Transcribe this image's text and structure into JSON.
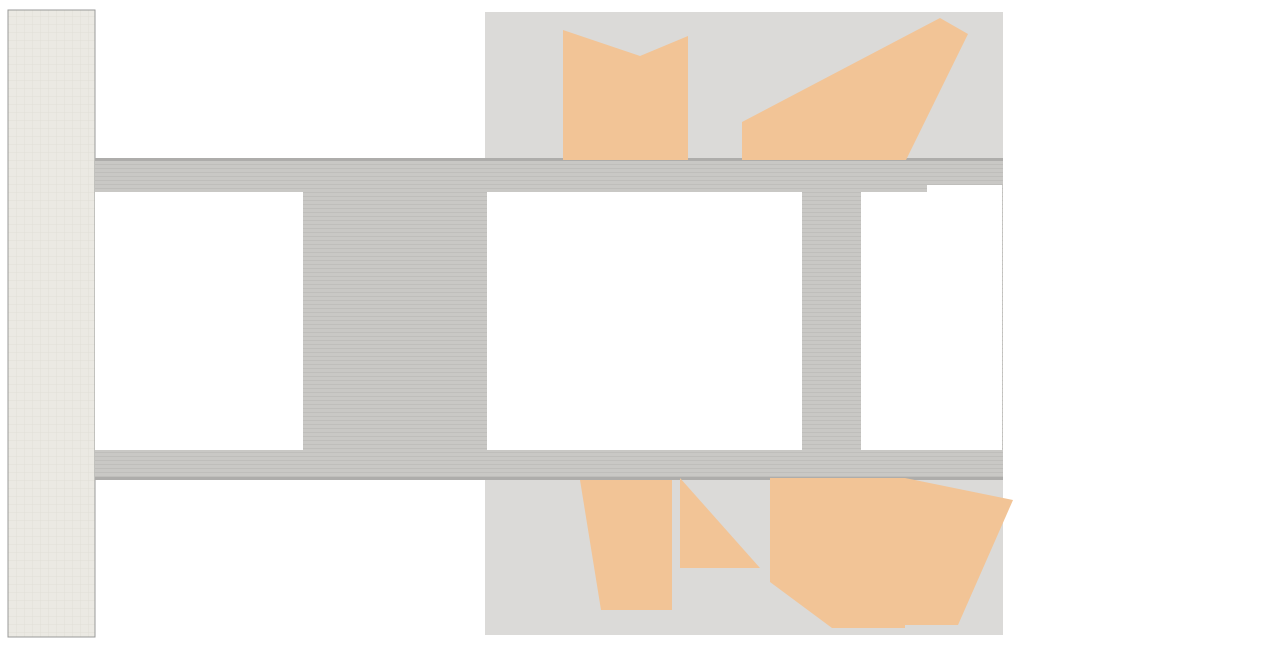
{
  "scene": {
    "w": 1280,
    "h": 645,
    "bg": "#ffffff",
    "description": "architectural office floor plan, no visible text"
  },
  "palette": {
    "office_floor": "#dbdad8",
    "corridor": "#c9c8c5",
    "corridor_edge": "#aeadab",
    "lounge_floor": "#ebe9e3",
    "wall_dark": "#545454",
    "line_gray": "#9a9a98",
    "line_light": "#c9c9c7",
    "column": "#616161",
    "column_halo": "#b9b8b5",
    "peach": "#f2c496",
    "blue_partition": "#7ea7c2",
    "tan_partition": "#c4ab8c",
    "gray_partition": "#b2b1af",
    "booth_seat": "#afc3d0",
    "booth_back": "#c9b394",
    "chair_dark": "#34302a",
    "chair_gray": "#b5b4b2",
    "chair_meeting": "#98948c",
    "table_beige": "#cfc4a6",
    "bench_green": "#8f9e55",
    "plant": "#c9d594",
    "plant_dark": "#8da05c",
    "spiral_brown": "#ad6b49",
    "furniture_dark": "#483c32",
    "wood_tan": "#b3905e",
    "red_chair": "#a85a3c",
    "white": "#ffffff",
    "tick": "#1b1b1b",
    "patch_gray": "#bdbcba",
    "chaise_gray": "#9c9c9a"
  },
  "floors": {
    "lounge": [
      8,
      10,
      87,
      627
    ],
    "mid_band": [
      95,
      158,
      908,
      322
    ],
    "office_top": [
      485,
      12,
      518,
      146
    ],
    "office_bottom": [
      485,
      478,
      518,
      157
    ],
    "corridor_edges": [
      [
        95,
        158,
        908,
        3
      ],
      [
        95,
        477,
        908,
        3
      ]
    ]
  },
  "white_blocks": [
    [
      95,
      192,
      208,
      258
    ],
    [
      487,
      192,
      73,
      258
    ],
    [
      556,
      192,
      16,
      258
    ],
    [
      568,
      192,
      234,
      258
    ],
    [
      861,
      192,
      66,
      258
    ],
    [
      927,
      185,
      75,
      265
    ]
  ],
  "voids": [
    [
      97,
      12,
      386,
      146
    ],
    [
      97,
      482,
      386,
      153
    ],
    [
      303,
      213,
      188,
      106
    ],
    [
      303,
      321,
      188,
      112
    ],
    [
      1005,
      12,
      263,
      310
    ],
    [
      1005,
      322,
      263,
      313
    ]
  ],
  "small_rect": [
    272,
    22,
    54,
    39
  ],
  "peach": [
    [
      563,
      30,
      640,
      56,
      688,
      36,
      688,
      160,
      563,
      160
    ],
    [
      742,
      122,
      940,
      18,
      968,
      34,
      906,
      160,
      742,
      160
    ],
    [
      580,
      480,
      672,
      480,
      672,
      610,
      601,
      610
    ],
    [
      680,
      478,
      760,
      568,
      680,
      568
    ],
    [
      770,
      478,
      905,
      478,
      905,
      628,
      832,
      628,
      770,
      582
    ],
    [
      905,
      478,
      1013,
      500,
      958,
      625,
      905,
      625
    ]
  ],
  "partitions": [
    {
      "x": 563,
      "y": 28,
      "h": 132,
      "t": "blue"
    },
    {
      "x": 718,
      "y": 40,
      "h": 118,
      "t": "tan"
    },
    {
      "x": 806,
      "y": 30,
      "h": 130,
      "t": "gb"
    },
    {
      "x": 897,
      "y": 30,
      "h": 130,
      "t": "gb"
    },
    {
      "x": 578,
      "y": 480,
      "h": 128,
      "t": "bg"
    },
    {
      "x": 671,
      "y": 480,
      "h": 128,
      "t": "bg"
    },
    {
      "x": 766,
      "y": 480,
      "h": 126,
      "t": "blue"
    },
    {
      "x": 897,
      "y": 478,
      "h": 130,
      "t": "tb"
    }
  ],
  "desk_banks": [
    [
      527,
      34,
      40,
      124
    ],
    [
      748,
      32,
      40,
      126
    ],
    [
      840,
      32,
      38,
      126
    ],
    [
      936,
      32,
      38,
      126
    ],
    [
      522,
      482,
      42,
      126
    ],
    [
      618,
      482,
      42,
      126
    ],
    [
      710,
      482,
      42,
      126
    ],
    [
      930,
      482,
      42,
      126
    ]
  ],
  "bank_rows": 5,
  "booths": {
    "top": {
      "x": 686,
      "w": 31,
      "h": 27,
      "ys": [
        40,
        77,
        123
      ],
      "rots": [
        -7,
        -4,
        -8
      ],
      "back": "left"
    },
    "bottom": {
      "x": 771,
      "w": 34,
      "h": 36,
      "ys": [
        482,
        524,
        566
      ],
      "rots": [
        6,
        -5,
        5
      ],
      "back": "top"
    }
  },
  "meetings": [
    {
      "cx": 640,
      "cy": 100,
      "rot": 4
    },
    {
      "cx": 857,
      "cy": 531,
      "rot": -14
    }
  ],
  "meeting_chairs": [
    [
      -34,
      -20,
      -35
    ],
    [
      -42,
      3,
      -85
    ],
    [
      -30,
      25,
      -135
    ],
    [
      32,
      -22,
      35
    ],
    [
      42,
      2,
      85
    ],
    [
      28,
      27,
      140
    ]
  ],
  "benches": [
    [
      594,
      12,
      100,
      11
    ],
    [
      806,
      619,
      94,
      12
    ]
  ],
  "round_tables": [
    [
      638,
      37
    ],
    [
      856,
      612
    ]
  ],
  "red_chairs": [
    [
      625,
      41,
      -25
    ],
    [
      652,
      42,
      25
    ],
    [
      839,
      607,
      -20
    ],
    [
      873,
      609,
      20
    ]
  ],
  "white_chairs": [
    [
      599,
      29,
      -15
    ],
    [
      673,
      31,
      14
    ],
    [
      818,
      616,
      -14
    ],
    [
      891,
      611,
      16
    ]
  ],
  "stools": [
    [
      604,
      45
    ],
    [
      667,
      55
    ],
    [
      822,
      597
    ]
  ],
  "plants": [
    [
      76,
      18,
      8
    ],
    [
      18,
      204,
      8
    ],
    [
      712,
      21,
      11
    ],
    [
      728,
      33,
      9
    ],
    [
      18,
      436,
      7
    ],
    [
      20,
      566,
      8
    ],
    [
      768,
      604,
      11
    ],
    [
      785,
      620,
      9
    ]
  ],
  "lounge_furniture": {
    "armchairs": [
      [
        38,
        22
      ],
      [
        60,
        22
      ]
    ],
    "sofa": [
      71,
      36,
      18,
      52
    ],
    "coffee_table": [
      31,
      48,
      30,
      25
    ],
    "ottoman": [
      47,
      96,
      9
    ],
    "tan_chairs": [
      [
        21,
        178,
        -25
      ],
      [
        12,
        193,
        15
      ],
      [
        27,
        429,
        -18
      ],
      [
        28,
        563,
        20
      ],
      [
        16,
        577,
        -10
      ]
    ],
    "chaises": [
      [
        28,
        607,
        -35
      ],
      [
        67,
        602,
        -32
      ]
    ],
    "tables4": [
      [
        68,
        136
      ],
      [
        63,
        513
      ],
      [
        48,
        555
      ]
    ]
  },
  "service_rooms": {
    "rooms": [
      [
        12,
        248,
        86,
        70
      ],
      [
        12,
        333,
        86,
        70
      ]
    ],
    "louver_size": [
      15,
      23
    ],
    "louvers": [
      [
        37,
        255
      ],
      [
        37,
        280
      ],
      [
        82,
        255
      ],
      [
        82,
        280
      ],
      [
        37,
        340
      ],
      [
        37,
        365
      ],
      [
        82,
        340
      ],
      [
        82,
        365
      ]
    ],
    "divider": [
      12,
      318,
      72,
      9
    ]
  },
  "stairs": {
    "scissor": [
      572,
      218,
      51,
      200
    ],
    "left_top": [
      173,
      197,
      76,
      54
    ],
    "left_bottom": [
      152,
      355,
      60,
      86
    ],
    "spiral": {
      "cx": 438,
      "cy": 531,
      "r": 34,
      "hole": 8,
      "flight": [
        404,
        472,
        32,
        60
      ]
    }
  },
  "xboxes": [
    [
      147,
      198,
      24,
      54
    ],
    [
      148,
      255,
      47,
      48
    ],
    [
      199,
      255,
      51,
      48
    ],
    [
      217,
      343,
      48,
      56
    ],
    [
      737,
      197,
      63,
      53
    ],
    [
      737,
      254,
      63,
      52
    ],
    [
      737,
      337,
      63,
      54
    ],
    [
      737,
      391,
      63,
      52
    ],
    [
      632,
      280,
      53,
      33
    ],
    [
      628,
      340,
      60,
      56
    ],
    [
      650,
      415,
      33,
      28
    ],
    [
      655,
      196,
      21,
      27
    ],
    [
      688,
      198,
      30,
      17
    ],
    [
      688,
      224,
      30,
      15
    ],
    [
      863,
      197,
      62,
      26
    ],
    [
      863,
      271,
      62,
      54
    ],
    [
      863,
      330,
      62,
      53
    ],
    [
      863,
      389,
      62,
      54
    ]
  ],
  "walls": [
    [
      140,
      190,
      115,
      7
    ],
    [
      296,
      196,
      8,
      46
    ],
    [
      296,
      270,
      8,
      56
    ],
    [
      296,
      356,
      8,
      60
    ],
    [
      296,
      425,
      8,
      25
    ],
    [
      138,
      196,
      5,
      60
    ],
    [
      138,
      350,
      5,
      92
    ],
    [
      140,
      443,
      132,
      7
    ],
    [
      303,
      206,
      188,
      7
    ],
    [
      303,
      434,
      188,
      8
    ],
    [
      556,
      192,
      86,
      6
    ],
    [
      660,
      192,
      32,
      6
    ],
    [
      733,
      192,
      69,
      6
    ],
    [
      556,
      198,
      11,
      58
    ],
    [
      556,
      276,
      11,
      52
    ],
    [
      556,
      344,
      11,
      58
    ],
    [
      556,
      418,
      11,
      30
    ],
    [
      737,
      249,
      63,
      5
    ],
    [
      735,
      306,
      67,
      6
    ],
    [
      737,
      384,
      63,
      5
    ],
    [
      735,
      442,
      67,
      7
    ],
    [
      672,
      200,
      16,
      18
    ],
    [
      621,
      294,
      13,
      50
    ],
    [
      674,
      424,
      12,
      22
    ],
    [
      598,
      440,
      60,
      7
    ],
    [
      863,
      266,
      62,
      4
    ],
    [
      863,
      326,
      62,
      4
    ],
    [
      863,
      384,
      62,
      4
    ],
    [
      863,
      443,
      62,
      6
    ],
    [
      481,
      478,
      5,
      157
    ],
    [
      999,
      13,
      4,
      55
    ],
    [
      232,
      336,
      38,
      6
    ]
  ],
  "wall_lines": [
    [
      143,
      192,
      143,
      450
    ],
    [
      95,
      268,
      143,
      268
    ],
    [
      95,
      352,
      143,
      352
    ],
    [
      487,
      192,
      487,
      450
    ],
    [
      560,
      192,
      560,
      450
    ],
    [
      487,
      255,
      545,
      255
    ],
    [
      487,
      305,
      545,
      305
    ],
    [
      487,
      335,
      545,
      335
    ],
    [
      487,
      395,
      545,
      395
    ],
    [
      927,
      185,
      927,
      450
    ],
    [
      1000,
      185,
      1000,
      450
    ],
    [
      927,
      258,
      1000,
      258
    ],
    [
      927,
      342,
      1000,
      342
    ],
    [
      927,
      390,
      1000,
      390
    ],
    [
      861,
      192,
      861,
      450
    ],
    [
      925,
      192,
      925,
      450
    ],
    [
      640,
      198,
      640,
      250
    ],
    [
      625,
      255,
      660,
      255
    ],
    [
      660,
      255,
      660,
      312
    ],
    [
      623,
      312,
      688,
      312
    ],
    [
      690,
      340,
      735,
      340
    ],
    [
      690,
      340,
      690,
      445
    ],
    [
      690,
      398,
      735,
      398
    ],
    [
      712,
      340,
      712,
      398
    ],
    [
      485,
      12,
      485,
      158
    ],
    [
      1003,
      12,
      1003,
      158
    ],
    [
      1003,
      478,
      1003,
      635
    ],
    [
      97,
      158,
      483,
      158
    ],
    [
      97,
      483,
      483,
      483
    ],
    [
      95,
      635,
      1005,
      635
    ],
    [
      485,
      12,
      1003,
      12
    ],
    [
      95,
      10,
      95,
      637
    ]
  ],
  "louvers": [
    [
      575,
      218,
      45,
      8,
      "h"
    ],
    [
      575,
      410,
      45,
      9,
      "h"
    ],
    [
      187,
      406,
      22,
      7,
      "h"
    ],
    [
      150,
      422,
      45,
      7,
      "h"
    ],
    [
      640,
      329,
      26,
      7,
      "h"
    ],
    [
      800,
      213,
      8,
      20,
      "v"
    ],
    [
      800,
      298,
      8,
      18,
      "v"
    ],
    [
      800,
      413,
      8,
      18,
      "v"
    ]
  ],
  "doors": [
    [
      95,
      198,
      22,
      90,
      180
    ],
    [
      95,
      446,
      20,
      180,
      270
    ],
    [
      123,
      214,
      16,
      270,
      360
    ],
    [
      123,
      310,
      16,
      0,
      90
    ],
    [
      123,
      398,
      15,
      270,
      360
    ],
    [
      548,
      230,
      17,
      180,
      270
    ],
    [
      548,
      382,
      17,
      90,
      180
    ],
    [
      927,
      238,
      17,
      0,
      90
    ],
    [
      927,
      408,
      17,
      270,
      360
    ],
    [
      812,
      170,
      22,
      0,
      90
    ],
    [
      856,
      170,
      22,
      90,
      180
    ],
    [
      812,
      474,
      22,
      270,
      360
    ],
    [
      856,
      474,
      22,
      180,
      270
    ],
    [
      802,
      252,
      24,
      270,
      360
    ],
    [
      802,
      338,
      24,
      270,
      360
    ],
    [
      802,
      416,
      22,
      270,
      360
    ],
    [
      640,
      252,
      15,
      90,
      180
    ],
    [
      688,
      302,
      15,
      180,
      270
    ],
    [
      660,
      430,
      14,
      180,
      270
    ],
    [
      176,
      312,
      18,
      90,
      180
    ],
    [
      250,
      312,
      18,
      0,
      90
    ],
    [
      233,
      420,
      15,
      180,
      270
    ],
    [
      950,
      205,
      15,
      90,
      180
    ],
    [
      950,
      432,
      15,
      180,
      270
    ],
    [
      545,
      210,
      16,
      90,
      180
    ],
    [
      490,
      162,
      24,
      0,
      90
    ]
  ],
  "bathrooms": {
    "gray_patches": [
      [
        523,
        208,
        30,
        45
      ],
      [
        523,
        388,
        30,
        44
      ],
      [
        927,
        185,
        38,
        63
      ],
      [
        927,
        390,
        38,
        60
      ]
    ],
    "toilets": [
      [
        497,
        213,
        90
      ],
      [
        497,
        237,
        90
      ],
      [
        508,
        262,
        0
      ],
      [
        532,
        262,
        0
      ],
      [
        508,
        392,
        180
      ],
      [
        532,
        392,
        180
      ],
      [
        955,
        232,
        0
      ],
      [
        982,
        232,
        0
      ],
      [
        955,
        408,
        180
      ],
      [
        982,
        408,
        180
      ]
    ],
    "counters": [
      [
        490,
        308,
        52,
        11
      ],
      [
        490,
        321,
        52,
        11
      ],
      [
        933,
        306,
        54,
        11
      ],
      [
        933,
        319,
        54,
        11
      ]
    ],
    "sinks": [
      [
        500,
        313.5
      ],
      [
        516,
        313.5
      ],
      [
        532,
        313.5
      ],
      [
        500,
        326.5
      ],
      [
        516,
        326.5
      ],
      [
        532,
        326.5
      ],
      [
        943,
        311.5
      ],
      [
        959,
        311.5
      ],
      [
        975,
        311.5
      ],
      [
        943,
        324.5
      ],
      [
        959,
        324.5
      ],
      [
        975,
        324.5
      ]
    ],
    "bowties": [
      [
        506,
        281
      ],
      [
        531,
        281
      ],
      [
        506,
        373
      ],
      [
        531,
        373
      ],
      [
        712,
        362
      ],
      [
        712,
        392
      ]
    ],
    "wheelchairs": [
      [
        643,
        264
      ],
      [
        640,
        406
      ]
    ],
    "fixtures": [
      [
        928,
        486,
        15,
        12
      ],
      [
        908,
        226,
        13,
        10
      ]
    ]
  },
  "columns": [
    [
      148,
      16
    ],
    [
      345,
      16
    ],
    [
      568,
      18
    ],
    [
      792,
      15
    ],
    [
      1002,
      15
    ],
    [
      1212,
      15
    ],
    [
      75,
      220
    ],
    [
      75,
      420
    ],
    [
      1002,
      322
    ],
    [
      1212,
      322
    ],
    [
      148,
      628
    ],
    [
      345,
      628
    ],
    [
      560,
      623
    ],
    [
      790,
      623
    ],
    [
      999,
      623
    ],
    [
      1212,
      623
    ]
  ],
  "ruler": {
    "spacing": 21.33,
    "len": 7,
    "thick": 2.2,
    "top_y": 1,
    "bottom_y": 637,
    "left_x": 1,
    "right_x": 1272,
    "start": 10,
    "end_x": 1270,
    "end_y": 636
  }
}
